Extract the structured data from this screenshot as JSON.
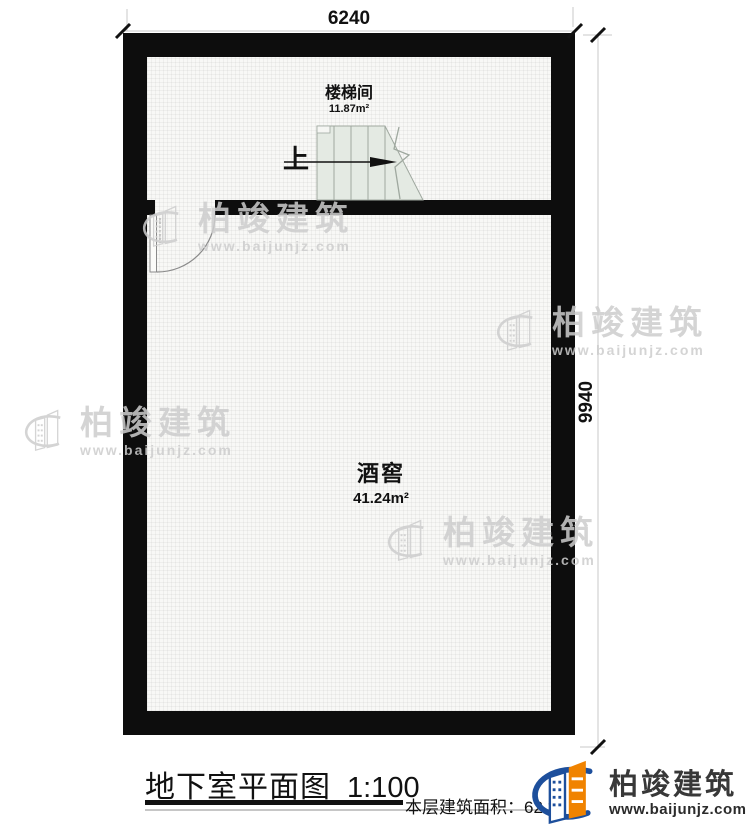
{
  "plan": {
    "top_dimension": "6240",
    "right_dimension": "9940",
    "rooms": [
      {
        "name": "楼梯间",
        "area": "11.87m²"
      },
      {
        "name": "酒窖",
        "area": "41.24m²"
      }
    ],
    "stairs": {
      "direction_label": "上"
    }
  },
  "footer": {
    "title": "地下室平面图",
    "scale": "1:100",
    "floor_area_label": "本层建筑面积：",
    "floor_area_value": "62.",
    "floor_area_obscured_digit": "3"
  },
  "brand": {
    "name": "柏竣建筑",
    "website": "www.baijunjz.com"
  },
  "watermark": {
    "name": "柏竣建筑",
    "website": "www.baijunjz.com"
  },
  "colors": {
    "wall": "#0d0d0d",
    "stairs_fill": "#e4eae3",
    "stairs_stroke": "#9fa89f",
    "brand_orange": "#f08300",
    "brand_blue": "#1d4f9c",
    "watermark_gray": "#cdcdcd"
  }
}
